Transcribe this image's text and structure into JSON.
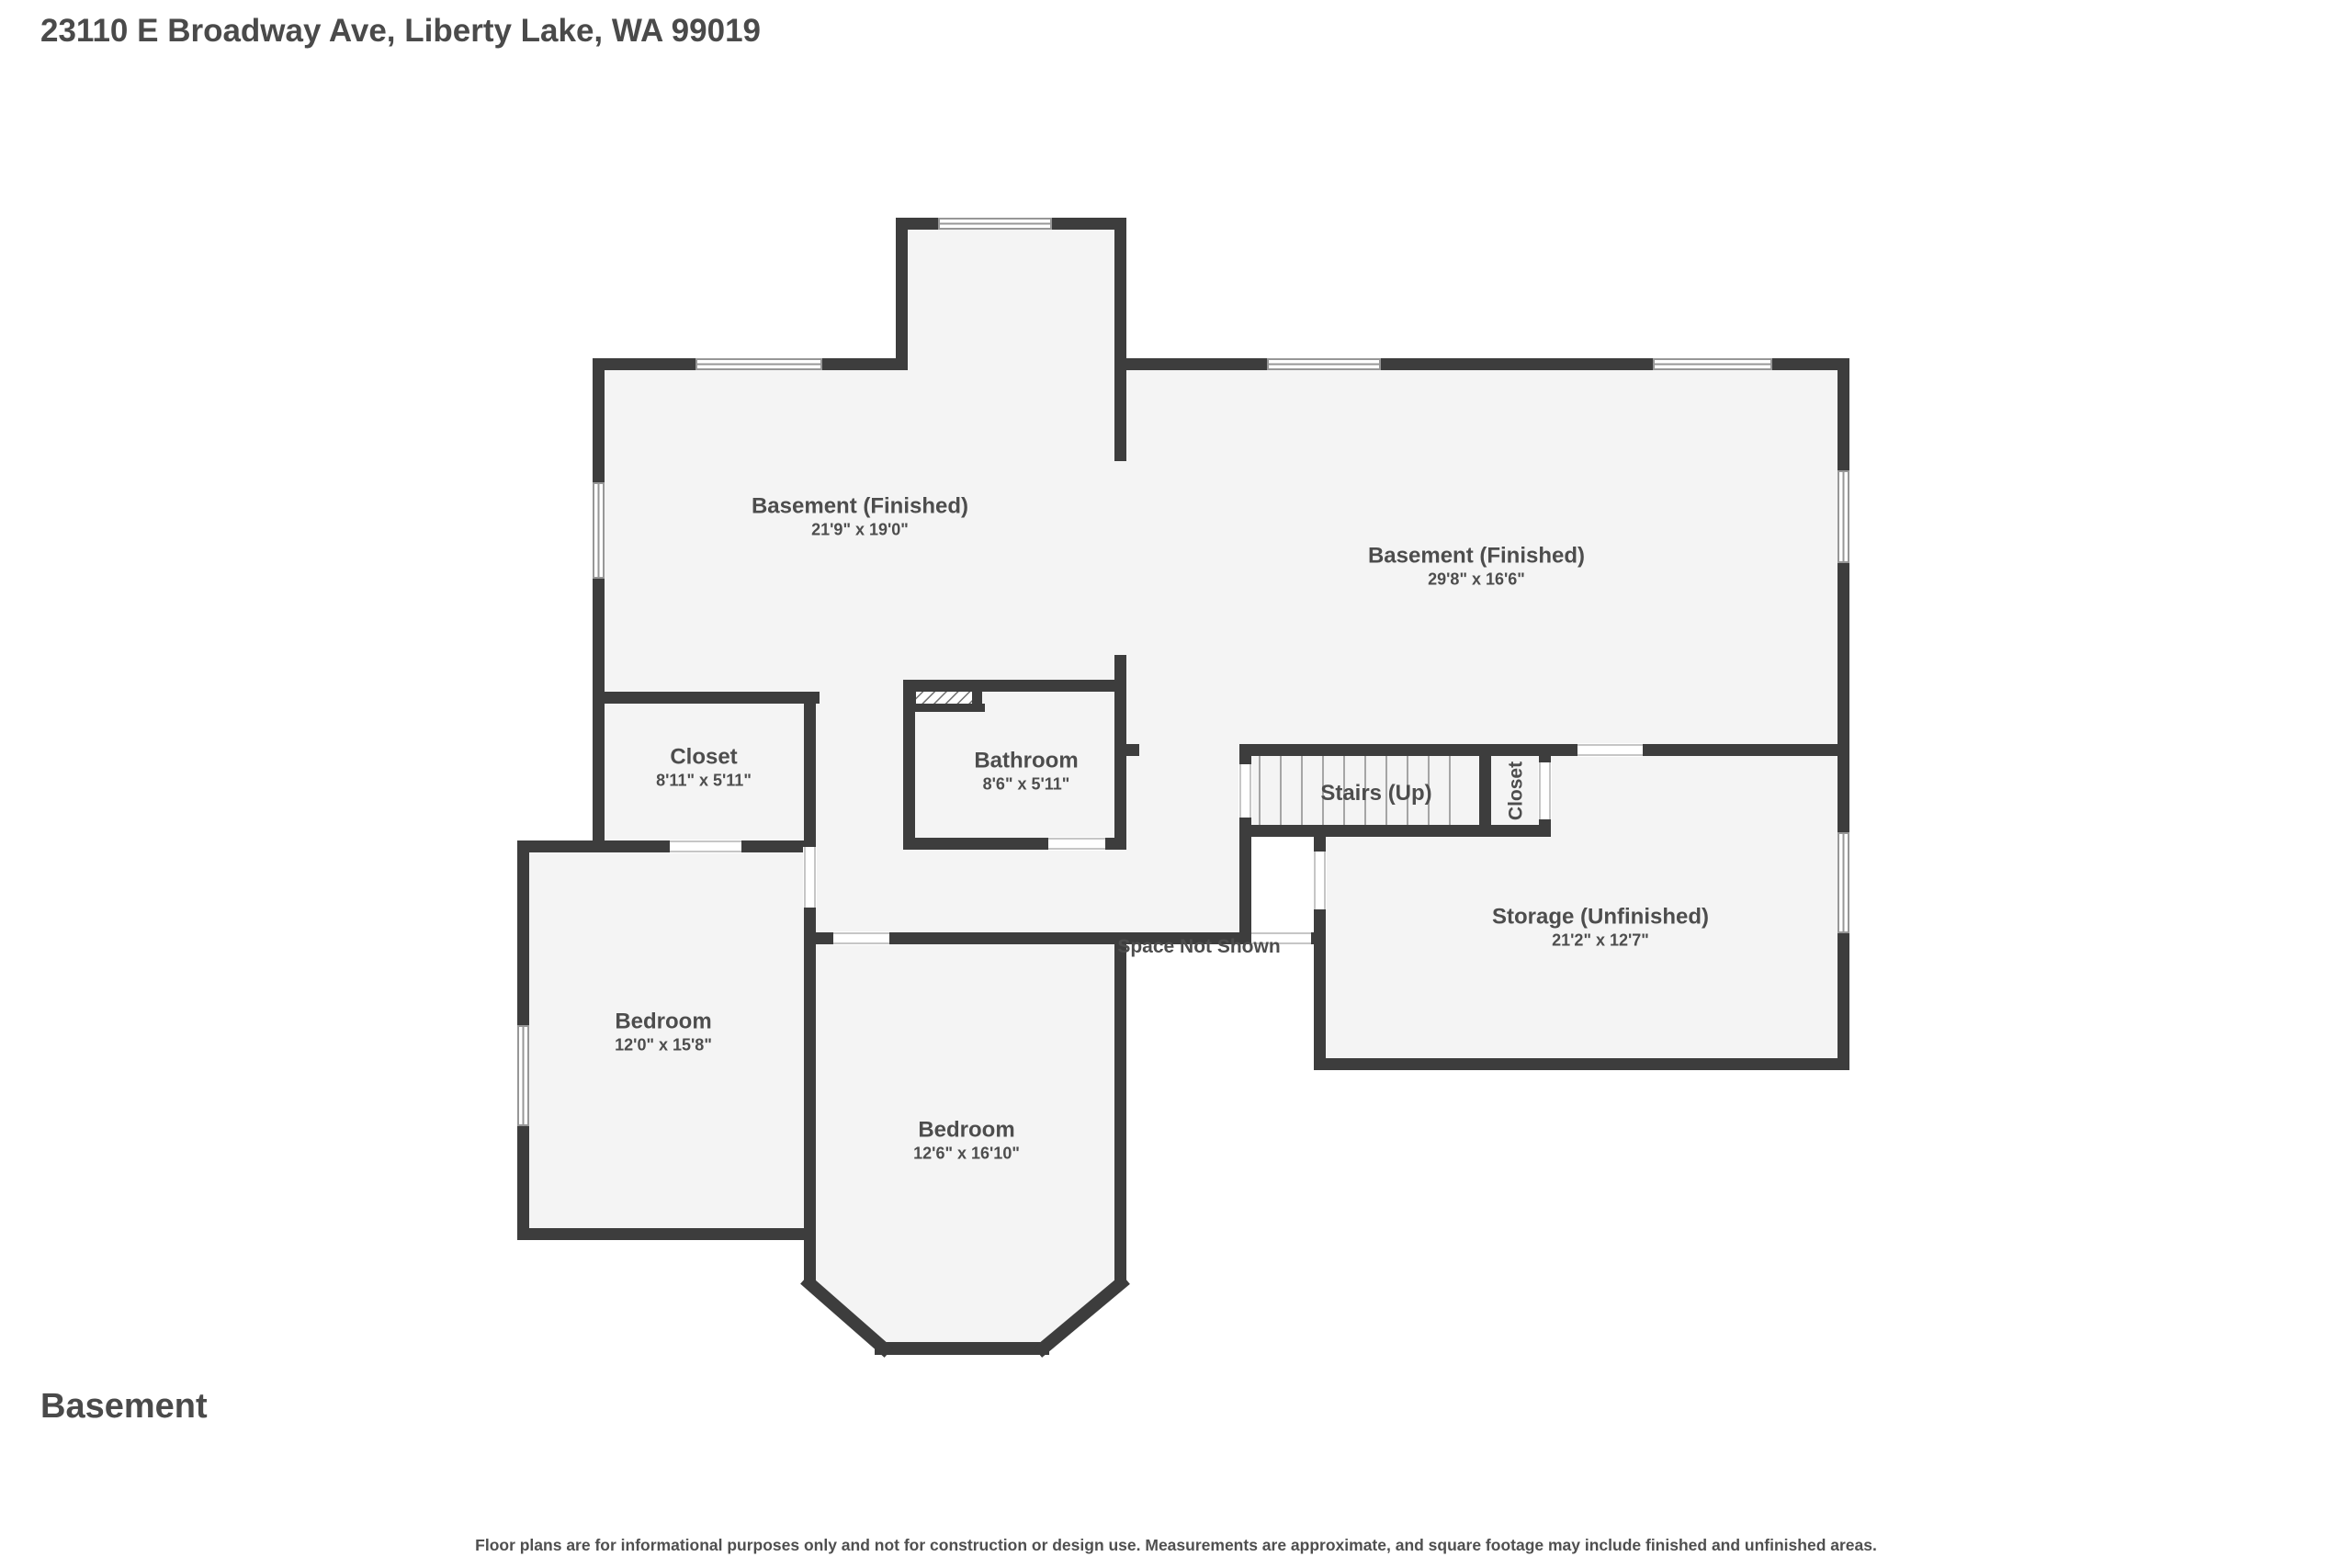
{
  "page": {
    "address_title": "23110 E Broadway Ave, Liberty Lake, WA 99019",
    "floor_name": "Basement",
    "disclaimer": "Floor plans are for informational purposes only and not for construction or design use. Measurements are approximate, and square footage may include finished and unfinished areas."
  },
  "rooms": [
    {
      "name": "Basement (Finished)",
      "dims": "21'9\" x 19'0\""
    },
    {
      "name": "Basement (Finished)",
      "dims": "29'8\" x 16'6\""
    },
    {
      "name": "Closet",
      "dims": "8'11\" x 5'11\""
    },
    {
      "name": "Bathroom",
      "dims": "8'6\" x 5'11\""
    },
    {
      "name": "Stairs (Up)",
      "dims": ""
    },
    {
      "name": "Closet",
      "dims": ""
    },
    {
      "name": "Storage (Unfinished)",
      "dims": "21'2\" x 12'7\""
    },
    {
      "name": "Bedroom",
      "dims": "12'0\" x 15'8\""
    },
    {
      "name": "Bedroom",
      "dims": "12'6\" x 16'10\""
    }
  ],
  "annotations": {
    "space_not_shown": "Space Not Shown"
  },
  "colors": {
    "wall": "#3d3d3d",
    "room_fill": "#f4f4f4",
    "text": "#4d4d4d",
    "background": "#ffffff"
  }
}
